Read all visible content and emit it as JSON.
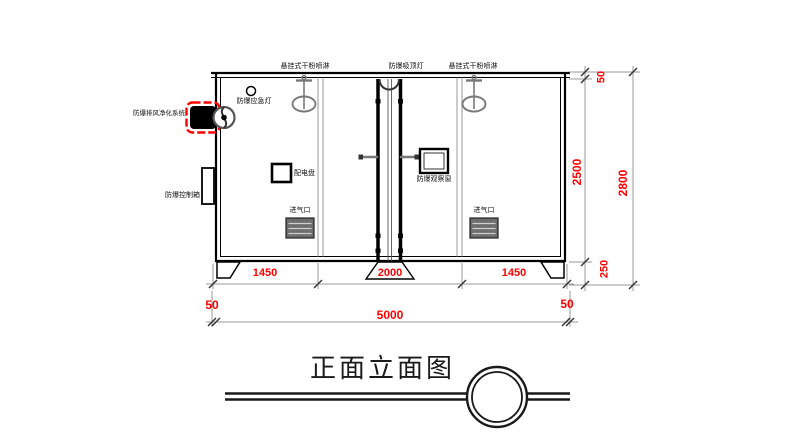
{
  "drawing": {
    "title": "正面立面图",
    "equipment_labels": {
      "sprinkler_left": "悬挂式干粉喷淋",
      "ceiling_light": "防爆吸顶灯",
      "sprinkler_right": "悬挂式干粉喷淋",
      "emergency_light": "防爆应急灯",
      "exhaust_purify_system": "防爆排风净化系统",
      "control_box": "防爆控制箱",
      "distribution_panel": "配电盘",
      "observation_window": "防爆观察窗",
      "air_inlet_left": "进气口",
      "air_inlet_right": "进气口"
    },
    "dimensions": {
      "width_segment_left": "1450",
      "width_segment_middle": "2000",
      "width_segment_right": "1450",
      "width_offset_left": "50",
      "width_total": "5000",
      "width_offset_right": "50",
      "height_roof": "50",
      "height_body": "2500",
      "height_base": "250",
      "height_total": "2800"
    },
    "colors": {
      "dimension_text": "#ff0000",
      "highlight_border": "#ff0000",
      "line": "#000000",
      "secondary_line": "#808080"
    }
  }
}
